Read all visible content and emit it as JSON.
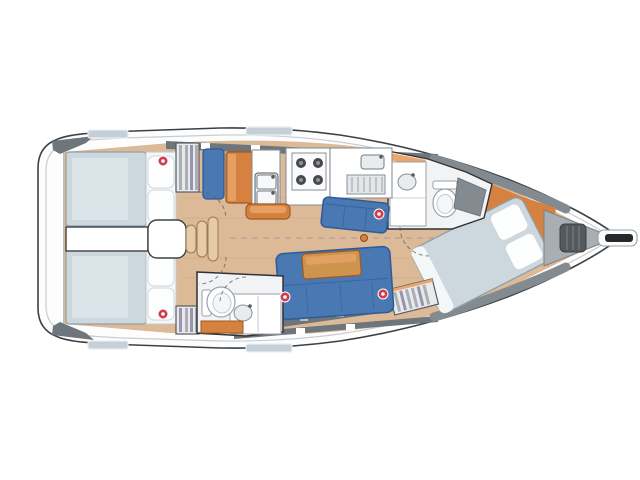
{
  "meta": {
    "title": "Sailboat interior layout floor plan, top view, bow pointing right",
    "background": "#ffffff"
  },
  "colors": {
    "hull_fill": "#fdfdfe",
    "hull_stroke": "#3b4147",
    "deck_line": "#c8cdd2",
    "deck_gray_dark": "#6e757b",
    "deck_gray_mid": "#848b90",
    "deck_gray_light": "#a8aeb3",
    "hatch_blue": "#c5cfd8",
    "floor_tan": "#dcb997",
    "mattress": "#cdd8de",
    "mattress_hi": "#dde6ea",
    "pillow": "#fdfefe",
    "berth_panel": "#f4f7f8",
    "settee_blue": "#4a78b2",
    "settee_blue_dark": "#2d5b97",
    "orange": "#d6813f",
    "orange_light": "#eaa66b",
    "wood_table": "#cf9350",
    "fixture_white": "#ffffff",
    "fixture_gray": "#e9eced",
    "room_floor": "#f2f3f4",
    "stripe_gray": "#a9afb5",
    "stripe_purple": "#9b93ad",
    "stove_dark": "#44494e",
    "windlass_gray": "#54595d",
    "marker_red": "#d23c4e",
    "roller_black": "#26292c"
  },
  "zones": {
    "boat": "Sailboat interior floor plan",
    "hull": "Hull and deck outline",
    "bowsprit": "Bowsprit with anchor roller",
    "anchor_locker": "Anchor locker with windlass",
    "forward_cabin": "Forward cabin with angled double berth",
    "forward_head": "Forward head with sink, toilet and shower seat",
    "galley": "Galley with double sink, two-burner stove top and counters",
    "nav_station": "Seat and chart table",
    "starboard_settee": "Upper salon settee",
    "port_settee": "Lower salon settee with table",
    "coffee_table": "Salon low table",
    "companionway": "Companionway steps and engine box",
    "aft_cabin_upper": "Upper aft cabin with double berth",
    "aft_cabin_lower": "Lower aft cabin with double berth",
    "aft_head": "Aft head with toilet and vanity sink",
    "hanging_locker_upper": "Hanging locker (upper)",
    "hanging_locker_lower": "Hanging locker (lower)",
    "forward_locker": "Forward stowage locker",
    "deck_hatch": "Deck hatch",
    "marker": "Red hatch marker",
    "mast_step": "Mast step on cabin sole"
  },
  "markers": {
    "red_marker_count": 5,
    "positions": [
      [
        163,
        161
      ],
      [
        163,
        314
      ],
      [
        379,
        214
      ],
      [
        285,
        297
      ],
      [
        383,
        294
      ]
    ]
  }
}
